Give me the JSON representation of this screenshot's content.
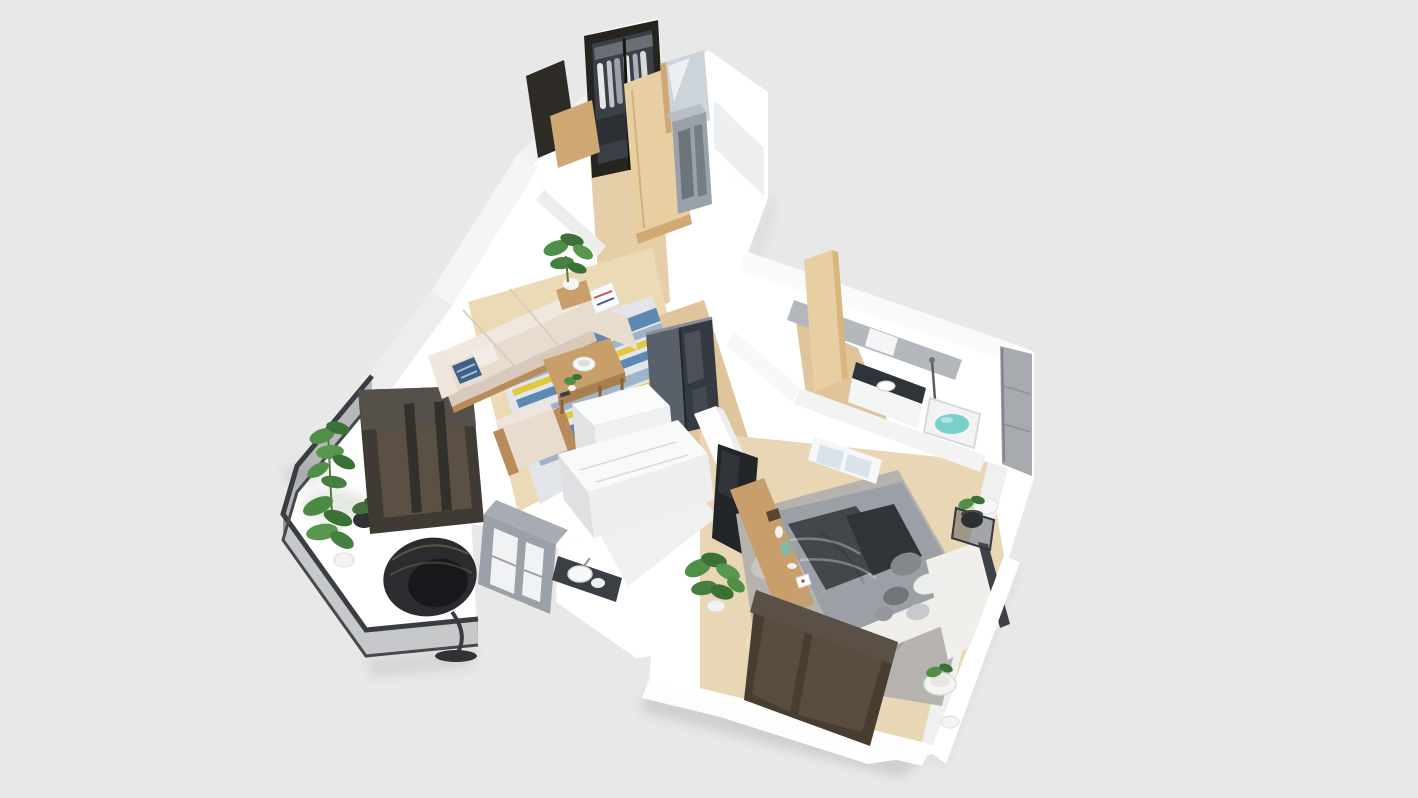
{
  "scene": {
    "description": "3D isometric cutaway (dollhouse) render of a one-bedroom apartment floor plan, viewed from above at an angle, centered on a plain light-gray background",
    "visible_text": "none",
    "background_color": "#e8e8e8",
    "rooms": [
      {
        "id": "entry-hall",
        "label": "Entry hall",
        "furniture": [
          "dark-framed glass wardrobe with hanging clothes",
          "open light-wood door",
          "dark entry door",
          "mirror panel",
          "gray shoe cabinet",
          "wood corridor floor"
        ]
      },
      {
        "id": "living-room",
        "label": "Living room",
        "furniture": [
          "beige L-shaped sofa with chaise",
          "blue patterned pillow",
          "white pillow with red stripe",
          "wooden coffee table with white bowl, small plant and remote",
          "beige wood-frame armchair",
          "white/blue/yellow striped area rug",
          "dark gray glossy refrigerator",
          "tall potted plant on wood stand"
        ]
      },
      {
        "id": "kitchen",
        "label": "Kitchen",
        "furniture": [
          "white cabinet blocks with pale worktops",
          "gray open shelving unit",
          "white washbasin on dark counter",
          "white marble floor patch"
        ]
      },
      {
        "id": "balcony",
        "label": "Balcony",
        "furniture": [
          "dark-framed glass railing",
          "white marble floor",
          "two potted green plants in white pots",
          "small dark planter",
          "black rattan egg chair",
          "large dark-framed window into living room"
        ]
      },
      {
        "id": "bathroom",
        "label": "Bathroom",
        "furniture": [
          "gray accent wall",
          "vanity with dark stone top and white basin",
          "bathtub with teal water",
          "shower column",
          "leaning light-wood door",
          "tall gray wall panel"
        ]
      },
      {
        "id": "bedroom",
        "label": "Bedroom",
        "furniture": [
          "double bed with gray duvet and dark throw",
          "white cushioned headboard",
          "white and gray pillows",
          "gray shag rug",
          "wood media console with vases and decor",
          "wall-mounted black TV on divider wall",
          "dark glass nightstand with black planter",
          "round white planters",
          "small white-framed interior window",
          "large dark-brown framed exterior window",
          "potted plant by the console"
        ]
      }
    ],
    "palette": {
      "background": "#e8e8e8",
      "wall_white": "#ffffff",
      "wall_shade_light": "#f2f2f3",
      "wall_shade": "#e9eaeb",
      "floor_wood": "#dfc49c",
      "floor_wood_light": "#e6cfa8",
      "floor_wood_pale": "#ecdab6",
      "marble_floor": "#eff0f0",
      "living_rug_base": "#e2e6ea",
      "rug_blue": "#5d88b2",
      "rug_yellow": "#e2c83d",
      "rug_slate": "#9fb4c9",
      "sofa_beige": "#e8dccf",
      "sofa_beige_dark": "#d9c9bb",
      "wood_furniture": "#c89e6a",
      "wood_door": "#e8cfa2",
      "dark_window_frame": "#473d31",
      "window_glass": "rgba(120,100,78,0.42)",
      "living_window_frame": "#3f3a33",
      "living_window_glass": "rgba(125,108,88,0.45)",
      "railing_glass": "rgba(70,72,78,0.30)",
      "railing_frame": "#3a3e42",
      "fridge_dark": "#343a42",
      "fridge_gray": "#596069",
      "cabinet_gray": "#9ba1a8",
      "panel_gray": "#a7abb0",
      "bath_wall_gray": "#b4b8bc",
      "counter_dark": "#3a3f45",
      "tub_water": "#79cfc9",
      "bed_duvet": "#9aa0a5",
      "bed_throw": "#43474c",
      "bed_white": "#f0eeea",
      "bedroom_rug": "#b6b2ae",
      "tv_black": "#22252a",
      "plant_green": "#4f8f47",
      "plant_dark": "#3c7136",
      "pot_white": "#f4f4f2",
      "door_dark": "#2e2a26",
      "wardrobe_dark": "#26241f"
    }
  }
}
